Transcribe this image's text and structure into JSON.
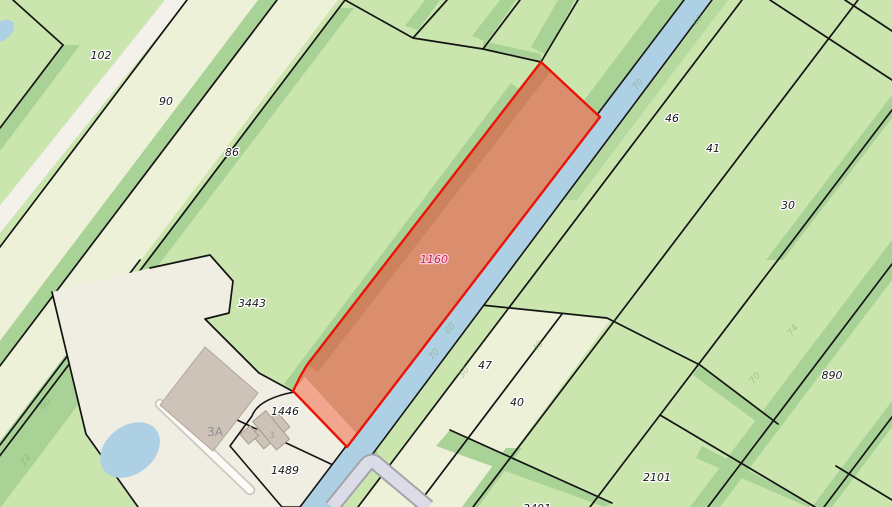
{
  "app": {
    "type": "cadastral-parcel-map"
  },
  "map": {
    "highlighted_parcel": {
      "number": "1160",
      "fill": "#da8e6d",
      "stroke": "#ea1408",
      "label_color": "#c9245d"
    },
    "labels": [
      {
        "text": "102",
        "x": 101,
        "y": 59,
        "kind": "parcel"
      },
      {
        "text": "90",
        "x": 166,
        "y": 105,
        "kind": "parcel"
      },
      {
        "text": "86",
        "x": 232,
        "y": 156,
        "kind": "parcel"
      },
      {
        "text": "3443",
        "x": 252,
        "y": 307,
        "kind": "parcel"
      },
      {
        "text": "1160",
        "x": 434,
        "y": 263,
        "kind": "highlight"
      },
      {
        "text": "46",
        "x": 672,
        "y": 122,
        "kind": "parcel"
      },
      {
        "text": "41",
        "x": 713,
        "y": 152,
        "kind": "parcel"
      },
      {
        "text": "30",
        "x": 788,
        "y": 209,
        "kind": "parcel"
      },
      {
        "text": "890",
        "x": 832,
        "y": 379,
        "kind": "parcel"
      },
      {
        "text": "47",
        "x": 485,
        "y": 369,
        "kind": "parcel"
      },
      {
        "text": "40",
        "x": 517,
        "y": 406,
        "kind": "parcel"
      },
      {
        "text": "2101",
        "x": 657,
        "y": 481,
        "kind": "parcel"
      },
      {
        "text": "2401",
        "x": 537,
        "y": 512,
        "kind": "parcel"
      },
      {
        "text": "1446",
        "x": 285,
        "y": 415,
        "kind": "parcel"
      },
      {
        "text": "1489",
        "x": 285,
        "y": 474,
        "kind": "parcel"
      },
      {
        "text": "3A",
        "x": 215,
        "y": 436,
        "kind": "address"
      },
      {
        "text": "3",
        "x": 272,
        "y": 438,
        "kind": "house"
      }
    ],
    "ditch_marks": [
      {
        "text": "40",
        "x": 700,
        "y": 22,
        "rotate": -52
      },
      {
        "text": "70",
        "x": 640,
        "y": 86,
        "rotate": -52
      },
      {
        "text": "80",
        "x": 452,
        "y": 330,
        "rotate": -52
      },
      {
        "text": "70",
        "x": 436,
        "y": 356,
        "rotate": -52
      },
      {
        "text": "30",
        "x": 466,
        "y": 374,
        "rotate": -52
      },
      {
        "text": "74",
        "x": 795,
        "y": 332,
        "rotate": -52
      },
      {
        "text": "70",
        "x": 757,
        "y": 380,
        "rotate": -52
      },
      {
        "text": "40",
        "x": 540,
        "y": 348,
        "rotate": -52
      },
      {
        "text": "90",
        "x": 48,
        "y": 406,
        "rotate": -52
      },
      {
        "text": "74",
        "x": 28,
        "y": 462,
        "rotate": -52
      }
    ],
    "colors": {
      "parcel_green": "#cbe5ae",
      "parcel_pale": "#edf1d8",
      "parcel_white": "#f3f1e9",
      "yard": "#f0ede3",
      "ditch": "#a9d296",
      "water": "#aed0e4",
      "boundary": "#141414",
      "road_fill": "#dbdce7",
      "road_edge": "#a4a4ac",
      "driveway_fill": "#fcfbf7",
      "driveway_edge": "#c9c9c1",
      "building": "#cdc3b9",
      "highlight_fill": "#da8e6d",
      "highlight_stroke": "#ea1408",
      "label_black": "#1a1a1a",
      "label_gray": "#8f8f8f",
      "highlight_label": "#c9245d"
    }
  }
}
